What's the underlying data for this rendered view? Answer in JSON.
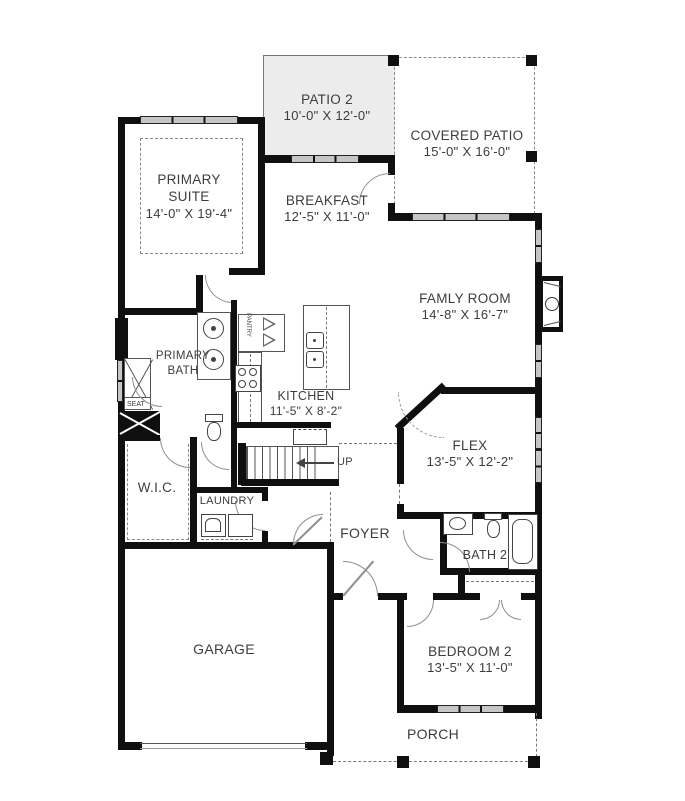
{
  "plan": {
    "title": "single-story floor plan",
    "colors": {
      "wall": "#0f0f0f",
      "window": "#c6c6c6",
      "patio_fill": "#ececec",
      "label": "#3d3d3d"
    },
    "rooms": {
      "patio2": {
        "name": "PATIO 2",
        "dims": "10'-0\" X 12'-0\""
      },
      "covered_patio": {
        "name": "COVERED PATIO",
        "dims": "15'-0\" X 16'-0\""
      },
      "primary_suite": {
        "line1": "PRIMARY",
        "line2": "SUITE",
        "dims": "14'-0\" X 19'-4\""
      },
      "breakfast": {
        "name": "BREAKFAST",
        "dims": "12'-5\" X 11'-0\""
      },
      "family_room": {
        "name": "FAMLY ROOM",
        "dims": "14'-8\" X 16'-7\""
      },
      "primary_bath": {
        "line1": "PRIMARY",
        "line2": "BATH"
      },
      "kitchen": {
        "name": "KITCHEN",
        "dims": "11'-5\" X 8'-2\""
      },
      "flex": {
        "name": "FLEX",
        "dims": "13'-5\" X 12'-2\""
      },
      "wic": {
        "name": "W.I.C."
      },
      "laundry": {
        "name": "LAUNDRY"
      },
      "foyer": {
        "name": "FOYER"
      },
      "bath2": {
        "name": "BATH 2"
      },
      "garage": {
        "name": "GARAGE"
      },
      "bedroom2": {
        "name": "BEDROOM 2",
        "dims": "13'-5\" X 11'-0\""
      },
      "porch": {
        "name": "PORCH"
      }
    },
    "annotations": {
      "seat": "SEAT",
      "pantry": "PANTRY",
      "up": "UP"
    }
  }
}
